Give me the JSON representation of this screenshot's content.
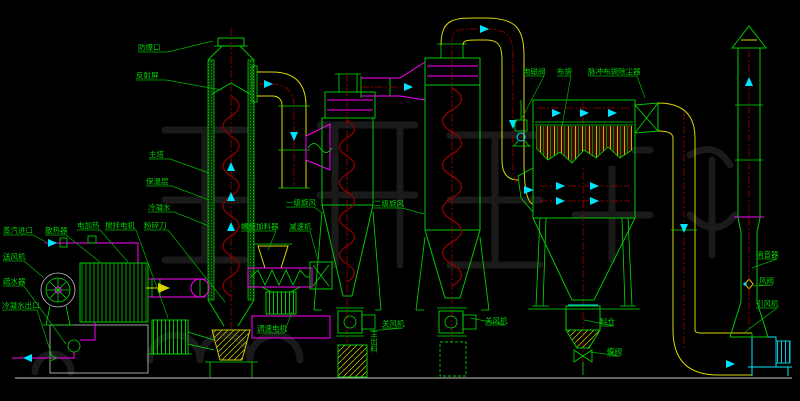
{
  "diagram": {
    "title": "drying-system-process-flow-diagram",
    "colors": {
      "background": "#000000",
      "line_green": "#00c800",
      "magenta": "#ff00ff",
      "yellow": "#d8d800",
      "cyan": "#00e5ff",
      "spiral_red": "#8b0000",
      "label_green": "#00d400",
      "ground_white": "#c8c8c8"
    },
    "labels": {
      "explosion_vent": "防爆口",
      "reflector_screen": "反射屏",
      "main_tower": "主塔",
      "insulation_layer": "保温层",
      "condensate": "冷凝水",
      "electric_heater": "电加热",
      "agitator_motor": "搅拌电机",
      "crusher_blade": "粉碎刀",
      "steam_inlet": "蒸汽进口",
      "radiator": "散热器",
      "blower": "送风机",
      "steam_trap": "疏水器",
      "condensate_outlet": "冷凝水出口",
      "screw_feeder": "螺旋加料器",
      "reducer": "减速机",
      "speed_motor": "调速电机",
      "cyclone_stage1": "一级旋风",
      "cyclone_stage2": "二级旋风",
      "main_discharge": "主出料",
      "airlock1": "关风机",
      "airlock2": "关风机",
      "solenoid_valve": "电磁阀",
      "cloth_bag": "布袋",
      "pulse_bag_filter": "脉冲布袋除尘器",
      "hopper": "料仓",
      "butterfly_valve": "蝶阀",
      "muffler": "消音器",
      "air_damper": "风阀",
      "induced_draft_fan": "引风机"
    }
  }
}
